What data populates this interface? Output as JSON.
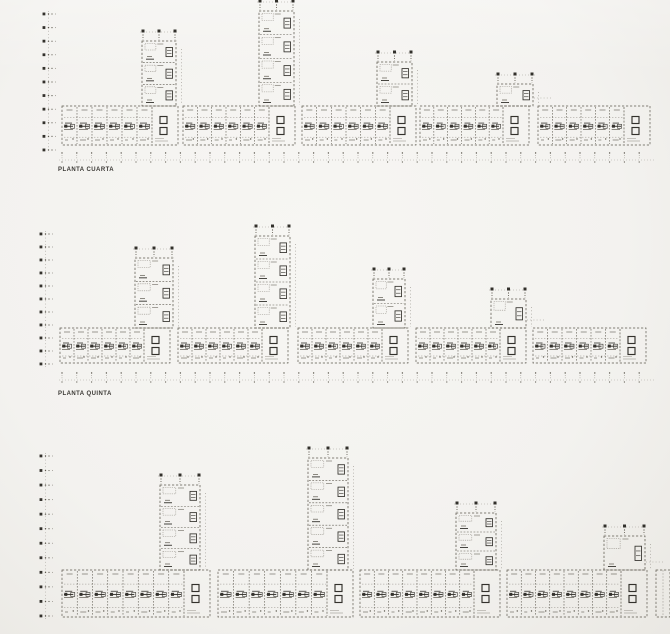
{
  "page": {
    "background": "#f3f2ef",
    "ink_light": "#96928a",
    "ink_mid": "#5d594f",
    "ink_dark": "#33312c",
    "label_color": "#3b3935"
  },
  "drawing": {
    "canvas": {
      "width": 670,
      "height": 634
    },
    "unit_width": 15,
    "core_width": 26,
    "rows": [
      {
        "name": "planta-cuarta",
        "label": "PLANTA CUARTA",
        "label_x": 58,
        "label_y": 167,
        "ruler": {
          "x": 44,
          "y1": 14,
          "y2": 150,
          "ticks": 11
        },
        "bar": {
          "y": 106,
          "h": 39
        },
        "grid_ticks": {
          "y": 152,
          "x1": 62,
          "x2": 652,
          "step": 14.8
        },
        "segments": [
          {
            "x": 62,
            "w": 116
          },
          {
            "x": 183,
            "w": 112
          },
          {
            "x": 302,
            "w": 114
          },
          {
            "x": 420,
            "w": 109
          },
          {
            "x": 538,
            "w": 112
          }
        ],
        "towers": [
          {
            "x": 142,
            "w": 34,
            "top": 41,
            "floors": 3
          },
          {
            "x": 259,
            "w": 35,
            "top": 11,
            "floors": 4
          },
          {
            "x": 377,
            "w": 35,
            "top": 62,
            "floors": 2
          },
          {
            "x": 497,
            "w": 36,
            "top": 84,
            "floors": 1
          }
        ]
      },
      {
        "name": "planta-quinta",
        "label": "PLANTA QUINTA",
        "label_x": 58,
        "label_y": 391,
        "ruler": {
          "x": 41,
          "y1": 234,
          "y2": 364,
          "ticks": 11
        },
        "bar": {
          "y": 328,
          "h": 35
        },
        "grid_ticks": {
          "y": 372,
          "x1": 62,
          "x2": 652,
          "step": 14.8
        },
        "segments": [
          {
            "x": 60,
            "w": 110
          },
          {
            "x": 178,
            "w": 110
          },
          {
            "x": 298,
            "w": 110
          },
          {
            "x": 416,
            "w": 110
          },
          {
            "x": 533,
            "w": 113
          }
        ],
        "towers": [
          {
            "x": 135,
            "w": 38,
            "top": 258,
            "floors": 3
          },
          {
            "x": 255,
            "w": 35,
            "top": 236,
            "floors": 4
          },
          {
            "x": 373,
            "w": 32,
            "top": 279,
            "floors": 2
          },
          {
            "x": 491,
            "w": 35,
            "top": 299,
            "floors": 1
          }
        ]
      },
      {
        "name": "planta-inferior-recortada",
        "label": "",
        "label_x": 58,
        "label_y": 632,
        "ruler": {
          "x": 41,
          "y1": 456,
          "y2": 616,
          "ticks": 12
        },
        "bar": {
          "y": 570,
          "h": 47
        },
        "grid_ticks": null,
        "segments": [
          {
            "x": 62,
            "w": 148
          },
          {
            "x": 218,
            "w": 135
          },
          {
            "x": 360,
            "w": 140
          },
          {
            "x": 507,
            "w": 140
          },
          {
            "x": 656,
            "w": 14
          }
        ],
        "towers": [
          {
            "x": 160,
            "w": 40,
            "top": 485,
            "floors": 4
          },
          {
            "x": 308,
            "w": 40,
            "top": 458,
            "floors": 5
          },
          {
            "x": 456,
            "w": 40,
            "top": 513,
            "floors": 3
          },
          {
            "x": 604,
            "w": 41,
            "top": 536,
            "floors": 1
          }
        ]
      }
    ]
  }
}
